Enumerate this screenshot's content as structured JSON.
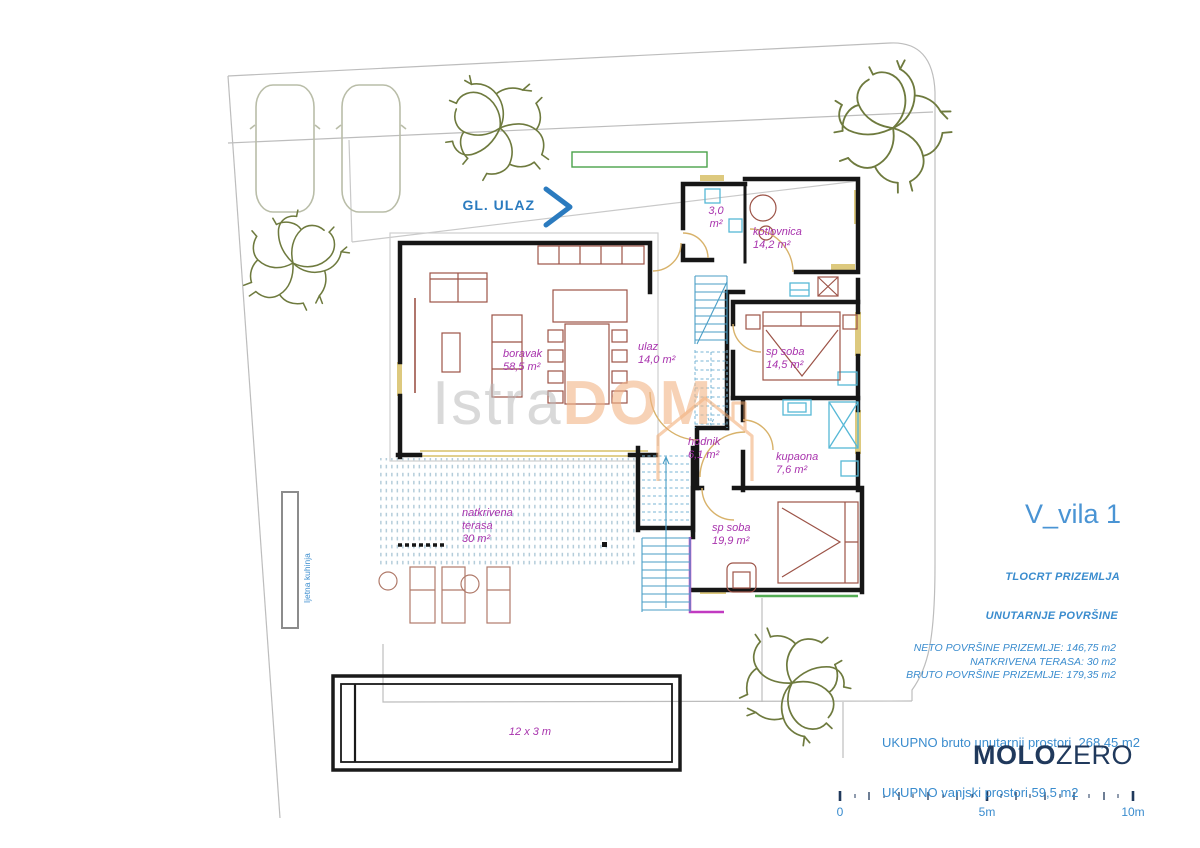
{
  "plan": {
    "entrance": {
      "label": "GL. ULAZ"
    },
    "site": {
      "summer_kitchen": "ljetna kuhinja",
      "pool_dimensions": "12 x 3 m"
    },
    "rooms": {
      "boravak": {
        "name": "boravak",
        "area": "58,5 m²"
      },
      "ulaz": {
        "name": "ulaz",
        "area": "14,0 m²"
      },
      "wc": {
        "name": "3,0",
        "area": "m²"
      },
      "kotlovnica": {
        "name": "kotlovnica",
        "area": "14,2 m²"
      },
      "sp_soba_1": {
        "name": "sp soba",
        "area": "14,5 m²"
      },
      "hodnik": {
        "name": "hodnik",
        "area": "6,1 m²"
      },
      "kupaona": {
        "name": "kupaona",
        "area": "7,6 m²"
      },
      "sp_soba_2": {
        "name": "sp soba",
        "area": "19,9 m²"
      },
      "terasa": {
        "name_line1": "natkrivena",
        "name_line2": "terasa",
        "area": "30 m²"
      }
    }
  },
  "titleblock": {
    "title": "V_vila 1",
    "drawing_name": "TLOCRT PRIZEMLJA",
    "section_heading": "UNUTARNJE POVRŠINE",
    "stats": [
      "NETO POVRŠINE PRIZEMLJE: 146,75 m2",
      "NATKRIVENA TERASA: 30 m2",
      "BRUTO POVRŠINE PRIZEMLJE: 179,35 m2"
    ],
    "totals": [
      "UKUPNO bruto unutarnji prostori  268,45 m2",
      "UKUPNO vanjski prostori 59,5 m2"
    ],
    "brand": {
      "bold": "MOLO",
      "light": "ZERO"
    }
  },
  "watermark": {
    "part1": "Istra",
    "part2": "DOM"
  },
  "scalebar": {
    "labels": [
      "0",
      "5m",
      "10m"
    ]
  },
  "colors": {
    "accent_blue": "#3a8cce",
    "label_magenta": "#a833ad",
    "brand_navy": "#20395c",
    "tree_olive": "#6e7a3e",
    "wall_black": "#161616",
    "window_yellow": "#ddc97e",
    "stairs_cyan": "#5aa7cc",
    "accent_green": "#55ad55",
    "accent_purple": "#c13ac1"
  }
}
